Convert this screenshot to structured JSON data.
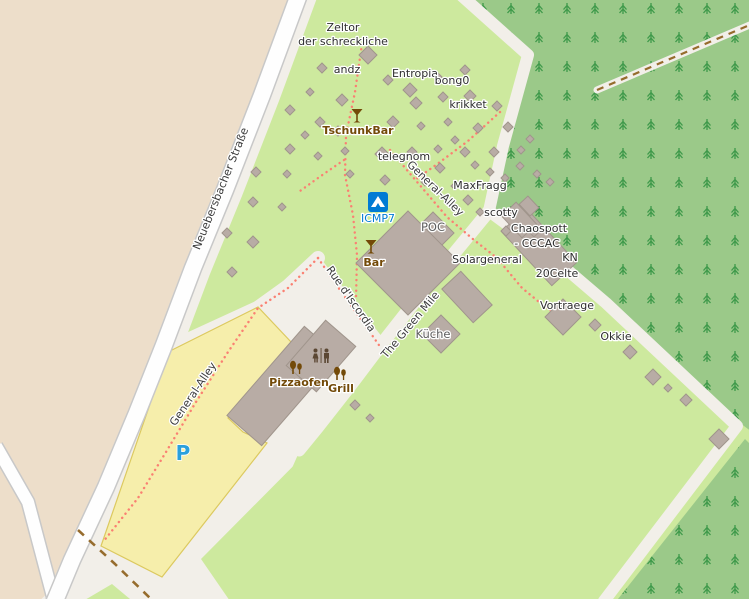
{
  "map": {
    "width": 749,
    "height": 599,
    "colors": {
      "camp_green": "#cde99e",
      "beige": "#eddeca",
      "forest_green": "#9bc989",
      "tree_green": "#3e994a",
      "cream": "#f2efe9",
      "road_fill": "#fefefe",
      "road_casing": "#c8c8c8",
      "parking_fill": "#f6eeab",
      "parking_stroke": "#dcc95f",
      "building_fill": "#b8aca5",
      "building_stroke": "#a0958c",
      "footpath_red": "#fa8072",
      "track_brown": "#966c2d",
      "poi_brown": "#734a08",
      "icmp_blue": "#007bd4",
      "parking_p_blue": "#2aa0dc",
      "toilets_brown": "#5b4733"
    },
    "polygons": {
      "beige": [
        [
          0,
          -4
        ],
        [
          291,
          -4
        ],
        [
          253,
          93
        ],
        [
          216,
          187
        ],
        [
          184,
          265
        ],
        [
          155,
          342
        ],
        [
          128,
          410
        ],
        [
          97,
          484
        ],
        [
          63,
          557
        ],
        [
          43,
          604
        ],
        [
          -4,
          604
        ]
      ],
      "forest_top_right": [
        [
          462,
          -4
        ],
        [
          531,
          57
        ],
        [
          503,
          146
        ],
        [
          489,
          211
        ],
        [
          607,
          303
        ],
        [
          744,
          426
        ],
        [
          752,
          432
        ],
        [
          752,
          -4
        ]
      ],
      "forest_bottom_right": [
        [
          745,
          439
        ],
        [
          752,
          446
        ],
        [
          752,
          604
        ],
        [
          614,
          604
        ]
      ],
      "apron": [
        [
          160,
          345
        ],
        [
          258,
          300
        ],
        [
          318,
          255
        ],
        [
          386,
          342
        ],
        [
          300,
          450
        ],
        [
          232,
          604
        ],
        [
          36,
          604
        ],
        [
          94,
          550
        ]
      ],
      "green_bottom": [
        [
          494,
          218
        ],
        [
          605,
          303
        ],
        [
          737,
          427
        ],
        [
          602,
          604
        ],
        [
          232,
          604
        ],
        [
          201,
          559
        ],
        [
          323,
          436
        ],
        [
          356,
          393
        ],
        [
          390,
          348
        ],
        [
          423,
          306
        ],
        [
          458,
          263
        ]
      ],
      "green_triangle": [
        [
          78,
          604
        ],
        [
          112,
          584
        ],
        [
          136,
          604
        ]
      ],
      "parking": [
        [
          168,
          352
        ],
        [
          258,
          307
        ],
        [
          292,
          343
        ],
        [
          228,
          418
        ],
        [
          243,
          432
        ],
        [
          267,
          443
        ],
        [
          162,
          577
        ],
        [
          101,
          546
        ]
      ]
    },
    "roads": {
      "main": [
        [
          300,
          -8
        ],
        [
          262,
          95
        ],
        [
          225,
          190
        ],
        [
          193,
          268
        ],
        [
          164,
          345
        ],
        [
          137,
          413
        ],
        [
          106,
          487
        ],
        [
          72,
          560
        ],
        [
          52,
          608
        ]
      ],
      "secondary": [
        [
          -4,
          446
        ],
        [
          28,
          502
        ],
        [
          56,
          608
        ]
      ]
    },
    "cream_paths": {
      "green_mile": [
        [
          489,
          211
        ],
        [
          452,
          256
        ],
        [
          417,
          299
        ],
        [
          384,
          341
        ],
        [
          350,
          386
        ],
        [
          317,
          428
        ],
        [
          299,
          450
        ]
      ],
      "parking_link": [
        [
          318,
          258
        ],
        [
          288,
          286
        ],
        [
          256,
          309
        ]
      ],
      "forest_edge": [
        [
          462,
          -4
        ],
        [
          528,
          55
        ],
        [
          503,
          146
        ],
        [
          489,
          211
        ],
        [
          558,
          262
        ],
        [
          606,
          303
        ],
        [
          737,
          426
        ],
        [
          604,
          601
        ]
      ],
      "forest_track_stripe": [
        [
          597,
          90
        ],
        [
          752,
          24
        ]
      ]
    },
    "dotted_paths": {
      "tschunk_path": [
        [
          362,
          44
        ],
        [
          355,
          92
        ],
        [
          346,
          135
        ],
        [
          345,
          175
        ],
        [
          353,
          215
        ],
        [
          357,
          255
        ],
        [
          356,
          300
        ]
      ],
      "branch_west": [
        [
          344,
          160
        ],
        [
          318,
          178
        ],
        [
          300,
          191
        ]
      ],
      "krikket_path": [
        [
          500,
          112
        ],
        [
          468,
          141
        ],
        [
          440,
          162
        ],
        [
          415,
          180
        ]
      ],
      "general_alley": [
        [
          390,
          150
        ],
        [
          412,
          176
        ],
        [
          447,
          217
        ],
        [
          474,
          240
        ],
        [
          497,
          258
        ],
        [
          522,
          288
        ],
        [
          544,
          306
        ],
        [
          558,
          315
        ]
      ],
      "rue_discordia": [
        [
          318,
          258
        ],
        [
          340,
          290
        ],
        [
          360,
          318
        ],
        [
          381,
          348
        ]
      ],
      "parking_path": [
        [
          318,
          258
        ],
        [
          288,
          288
        ],
        [
          258,
          308
        ],
        [
          228,
          352
        ],
        [
          196,
          402
        ],
        [
          166,
          452
        ],
        [
          138,
          498
        ],
        [
          103,
          542
        ]
      ]
    },
    "tracks": {
      "bottom_left": [
        [
          78,
          530
        ],
        [
          115,
          564
        ],
        [
          152,
          600
        ]
      ],
      "forest_top": [
        [
          597,
          90
        ],
        [
          752,
          24
        ]
      ]
    },
    "trees_grid": {
      "x0": 455,
      "x1": 750,
      "dx": 28,
      "y0": 8,
      "y1": 600,
      "dy": 29
    },
    "diamonds": [
      [
        368,
        55,
        9
      ],
      [
        322,
        68,
        5
      ],
      [
        388,
        80,
        5
      ],
      [
        410,
        90,
        7
      ],
      [
        438,
        77,
        4
      ],
      [
        465,
        70,
        5
      ],
      [
        342,
        100,
        6
      ],
      [
        310,
        92,
        4
      ],
      [
        416,
        103,
        6
      ],
      [
        443,
        97,
        5
      ],
      [
        470,
        96,
        6
      ],
      [
        497,
        106,
        5
      ],
      [
        290,
        110,
        5
      ],
      [
        320,
        122,
        5
      ],
      [
        305,
        135,
        4
      ],
      [
        338,
        131,
        5
      ],
      [
        393,
        122,
        6
      ],
      [
        421,
        126,
        4
      ],
      [
        448,
        122,
        4
      ],
      [
        478,
        128,
        5
      ],
      [
        508,
        127,
        5
      ],
      [
        290,
        149,
        5
      ],
      [
        318,
        156,
        4
      ],
      [
        345,
        151,
        4
      ],
      [
        382,
        154,
        7
      ],
      [
        412,
        152,
        5
      ],
      [
        438,
        149,
        4
      ],
      [
        465,
        152,
        5
      ],
      [
        494,
        152,
        5
      ],
      [
        521,
        150,
        4
      ],
      [
        256,
        172,
        5
      ],
      [
        287,
        174,
        4
      ],
      [
        350,
        174,
        4
      ],
      [
        385,
        180,
        5
      ],
      [
        253,
        202,
        5
      ],
      [
        282,
        207,
        4
      ],
      [
        227,
        233,
        5
      ],
      [
        253,
        242,
        6
      ],
      [
        232,
        272,
        5
      ],
      [
        455,
        140,
        4
      ],
      [
        530,
        139,
        4
      ],
      [
        475,
        165,
        4
      ],
      [
        490,
        172,
        4
      ],
      [
        505,
        178,
        4
      ],
      [
        520,
        166,
        4
      ],
      [
        537,
        174,
        4
      ],
      [
        550,
        182,
        4
      ],
      [
        440,
        168,
        5
      ],
      [
        425,
        182,
        4
      ],
      [
        455,
        186,
        4
      ],
      [
        468,
        200,
        5
      ],
      [
        480,
        212,
        4
      ],
      [
        506,
        231,
        5
      ],
      [
        534,
        233,
        4
      ],
      [
        595,
        325,
        6
      ],
      [
        630,
        352,
        7
      ],
      [
        653,
        377,
        8
      ],
      [
        668,
        388,
        4
      ],
      [
        686,
        400,
        6
      ],
      [
        719,
        439,
        10
      ],
      [
        355,
        405,
        5
      ],
      [
        370,
        418,
        4
      ],
      [
        441,
        334,
        19
      ],
      [
        563,
        317,
        18
      ],
      [
        433,
        233,
        21
      ],
      [
        408,
        263,
        52
      ]
    ],
    "rect_buildings": [
      [
        539,
        247,
        74,
        34,
        47
      ],
      [
        467,
        297,
        46,
        26,
        47
      ],
      [
        283,
        386,
        118,
        46,
        -49
      ],
      [
        321,
        356,
        60,
        40,
        -49
      ],
      [
        519,
        220,
        30,
        20,
        47
      ],
      [
        529,
        206,
        16,
        12,
        47
      ]
    ],
    "icons": [
      {
        "type": "cocktail",
        "name": "cocktail-icon-tschunkbar",
        "x": 357,
        "y": 116
      },
      {
        "type": "cocktail",
        "name": "cocktail-icon-bar",
        "x": 371,
        "y": 247
      },
      {
        "type": "campsite",
        "name": "campsite-icon-icmp7",
        "x": 378,
        "y": 202
      },
      {
        "type": "toilets",
        "name": "toilets-icon",
        "x": 321,
        "y": 357
      },
      {
        "type": "food",
        "name": "food-stand-icon-pizzaofen",
        "x": 296,
        "y": 368
      },
      {
        "type": "food",
        "name": "food-stand-icon-grill",
        "x": 340,
        "y": 374
      }
    ],
    "labels": [
      {
        "t": "Zeltor",
        "x": 343,
        "y": 31,
        "c": "b"
      },
      {
        "t": "der schreckliche",
        "x": 343,
        "y": 45,
        "c": "b"
      },
      {
        "t": "andz",
        "x": 347,
        "y": 73,
        "c": "b"
      },
      {
        "t": "Entropia",
        "x": 415,
        "y": 77,
        "c": "b"
      },
      {
        "t": "bong0",
        "x": 452,
        "y": 84,
        "c": "b"
      },
      {
        "t": "krikket",
        "x": 468,
        "y": 108,
        "c": "b"
      },
      {
        "t": "TschunkBar",
        "x": 358,
        "y": 134,
        "c": "poi"
      },
      {
        "t": "telegnom",
        "x": 404,
        "y": 160,
        "c": "b"
      },
      {
        "t": "General-Alley",
        "x": 433,
        "y": 191,
        "r": 44,
        "c": "street"
      },
      {
        "t": "MaxFragg",
        "x": 480,
        "y": 189,
        "c": "b"
      },
      {
        "t": "scotty",
        "x": 501,
        "y": 216,
        "c": "b"
      },
      {
        "t": "ICMP7",
        "x": 378,
        "y": 222,
        "c": "blue"
      },
      {
        "t": "POC",
        "x": 433,
        "y": 231,
        "c": "g"
      },
      {
        "t": "Chaospott",
        "x": 539,
        "y": 232,
        "c": "b"
      },
      {
        "t": "- CCCAC",
        "x": 537,
        "y": 247,
        "c": "b"
      },
      {
        "t": "Bar",
        "x": 374,
        "y": 266,
        "c": "poi"
      },
      {
        "t": "Solargeneral",
        "x": 487,
        "y": 263,
        "c": "b"
      },
      {
        "t": "KN",
        "x": 570,
        "y": 261,
        "c": "b"
      },
      {
        "t": "20Celte",
        "x": 557,
        "y": 277,
        "c": "b"
      },
      {
        "t": "Vortraege",
        "x": 567,
        "y": 309,
        "c": "b"
      },
      {
        "t": "Okkie",
        "x": 616,
        "y": 340,
        "c": "b"
      },
      {
        "t": "Küche",
        "x": 433,
        "y": 338,
        "c": "g"
      },
      {
        "t": "The Green Mile",
        "x": 413,
        "y": 327,
        "r": -50,
        "c": "street"
      },
      {
        "t": "Rue d'Iscordia",
        "x": 348,
        "y": 301,
        "r": 55,
        "c": "street"
      },
      {
        "t": "Pizzaofen",
        "x": 299,
        "y": 386,
        "c": "poi"
      },
      {
        "t": "Grill",
        "x": 341,
        "y": 392,
        "c": "poi"
      },
      {
        "t": "General-Alley",
        "x": 196,
        "y": 396,
        "r": -56,
        "c": "street"
      },
      {
        "t": "Neuebersbacher Straße",
        "x": 224,
        "y": 190,
        "r": -68,
        "c": "street"
      },
      {
        "t": "P",
        "x": 183,
        "y": 460,
        "c": "bluep"
      }
    ]
  }
}
